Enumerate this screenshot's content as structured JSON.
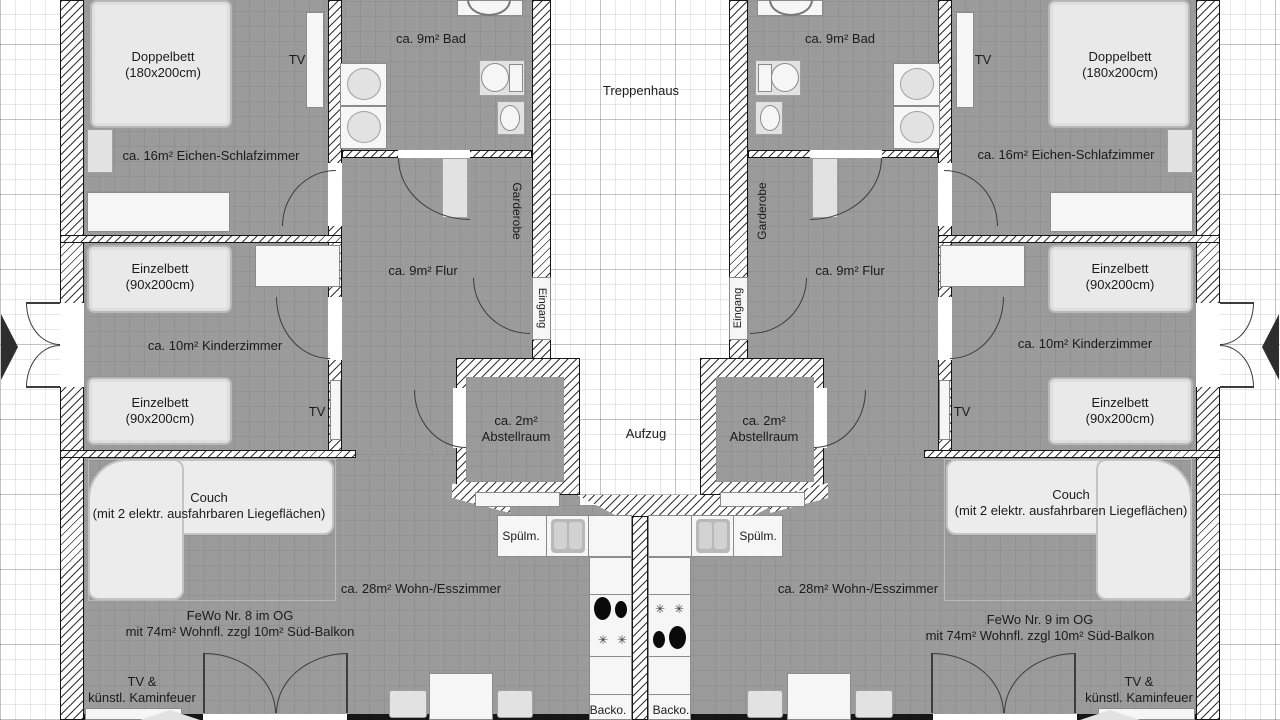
{
  "floorplan": {
    "center": {
      "stairwell": "Treppenhaus",
      "elevator": "Aufzug"
    },
    "labels": {
      "bedroom": "ca. 16m² Eichen-Schlafzimmer",
      "bath": "ca. 9m² Bad",
      "hall": "ca. 9m² Flur",
      "kids": "ca. 10m² Kinderzimmer",
      "living": "ca. 28m² Wohn-/Esszimmer",
      "storage_1": "ca. 2m²",
      "storage_2": "Abstellraum",
      "wardrobe": "Garderobe",
      "entrance": "Eingang"
    },
    "furniture": {
      "double_bed_1": "Doppelbett",
      "double_bed_2": "(180x200cm)",
      "single_bed_1": "Einzelbett",
      "single_bed_2": "(90x200cm)",
      "tv": "TV",
      "couch_1": "Couch",
      "couch_2": "(mit 2 elektr. ausfahrbaren Liegeflächen)",
      "dishwasher": "Spülm.",
      "oven": "Backo.",
      "tv_fireplace_1": "TV &",
      "tv_fireplace_2": "künstl. Kaminfeuer"
    },
    "units": [
      {
        "line1": "FeWo Nr. 8 im OG",
        "line2": "mit 74m² Wohnfl. zzgl 10m² Süd-Balkon"
      },
      {
        "line1": "FeWo Nr. 9 im OG",
        "line2": "mit 74m² Wohnfl. zzgl 10m² Süd-Balkon"
      }
    ],
    "icons": {
      "burner_star": "✳"
    },
    "colors": {
      "room_fill": "#9b9b9b",
      "wall_line": "#161616",
      "background": "#ffffff"
    }
  }
}
